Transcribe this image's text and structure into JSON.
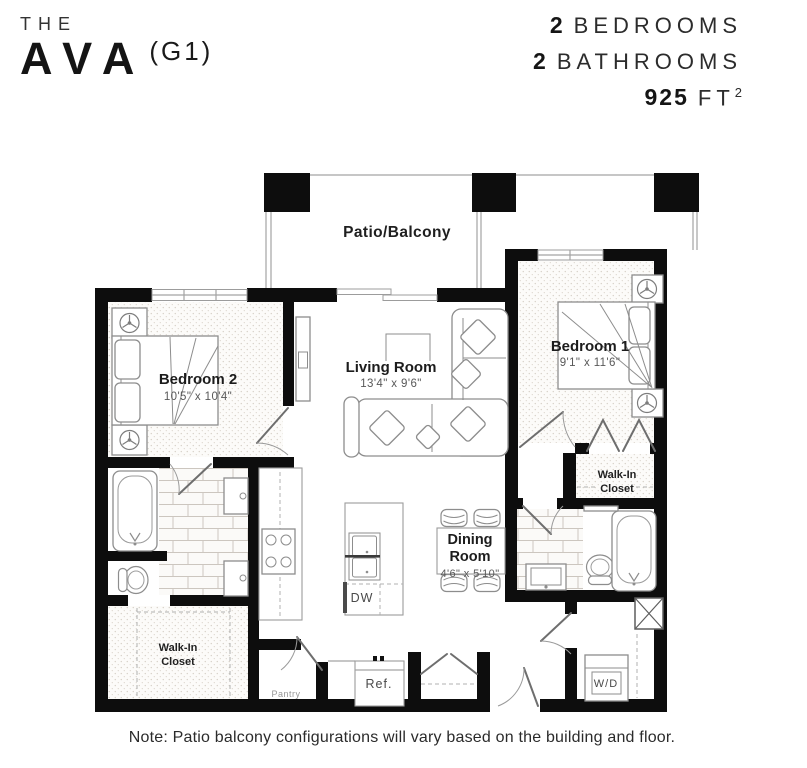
{
  "header": {
    "brand": {
      "the": "THE",
      "name": "AVA",
      "variant": "(G1)"
    },
    "specs": {
      "bedrooms": {
        "num": "2",
        "label": "BEDROOMS"
      },
      "bathrooms": {
        "num": "2",
        "label": "BATHROOMS"
      },
      "area": {
        "num": "925",
        "unit": "FT",
        "sup": "2"
      }
    }
  },
  "plan": {
    "patio": {
      "label": "Patio/Balcony"
    },
    "bedroom2": {
      "name": "Bedroom 2",
      "dims": "10'5\" x 10'4\""
    },
    "living": {
      "name": "Living Room",
      "dims": "13'4\" x 9'6\""
    },
    "bedroom1": {
      "name": "Bedroom 1",
      "dims": "9'1\" x 11'6\""
    },
    "dining": {
      "name_line1": "Dining",
      "name_line2": "Room",
      "dims": "4'6\" x 5'10\""
    },
    "walkin_left": {
      "line1": "Walk-In",
      "line2": "Closet"
    },
    "walkin_right": {
      "line1": "Walk-In",
      "line2": "Closet"
    },
    "labels": {
      "dw": "DW",
      "ref": "Ref.",
      "pantry": "Pantry",
      "wd": "W/D"
    }
  },
  "note": "Note: Patio balcony configurations will vary based on the building and floor."
}
